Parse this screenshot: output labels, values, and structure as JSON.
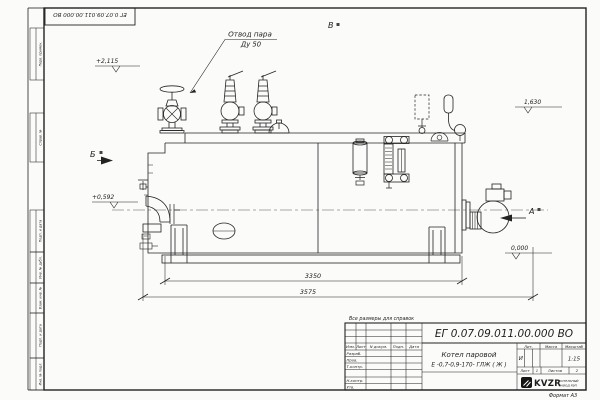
{
  "stamp": {
    "doc_number_rotated": "ЕГ 0.07.09.011.00.000  ВО"
  },
  "margin": {
    "labels": [
      "Перв. примен.",
      "Справ. №",
      "Подп. и дата",
      "Инв. № дубл.",
      "Взам. инв. №",
      "Подп. и дата",
      "Инв. № подл."
    ]
  },
  "drawing": {
    "callout": {
      "line1": "Отвод пара",
      "line2": "Ду 50"
    },
    "view_markers": {
      "a": "А",
      "b": "Б",
      "v": "В"
    },
    "elevations": {
      "top": "+2,115",
      "middle": "+0,592",
      "right": "1,630",
      "zero": "0,000"
    },
    "dimensions": {
      "inner": "3350",
      "overall": "3575"
    }
  },
  "title_block": {
    "note": "Все размеры для справок",
    "doc_number": "ЕГ 0.07.09.011.00.000  ВО",
    "product_line1": "Котел паровой",
    "product_line2": "Е -0,7-0,9-170- ГЛЖ ( Ж )",
    "header": {
      "izm": "Изм.",
      "list": "Лист",
      "ndoc": "N докум.",
      "podp": "Подп.",
      "data": "Дата"
    },
    "rows": {
      "razrab": "Разраб.",
      "prov": "Пров.",
      "tkontr": "Т.контр.",
      "nkontr": "Н.контр.",
      "utv": "Утв."
    },
    "lit_header": "Лит.",
    "lit_value": "И",
    "mass_header": "Масса",
    "scale_header": "Масштаб",
    "scale_value": "1:15",
    "sheet_label": "Лист",
    "sheet_value": "1",
    "sheets_label": "Листов",
    "sheets_value": "2",
    "logo_text": "KVZR",
    "logo_sub1": "КОТЕЛЬНЫЙ",
    "logo_sub2": "ЗАВОД РЭП",
    "format_label": "Формат А3"
  }
}
